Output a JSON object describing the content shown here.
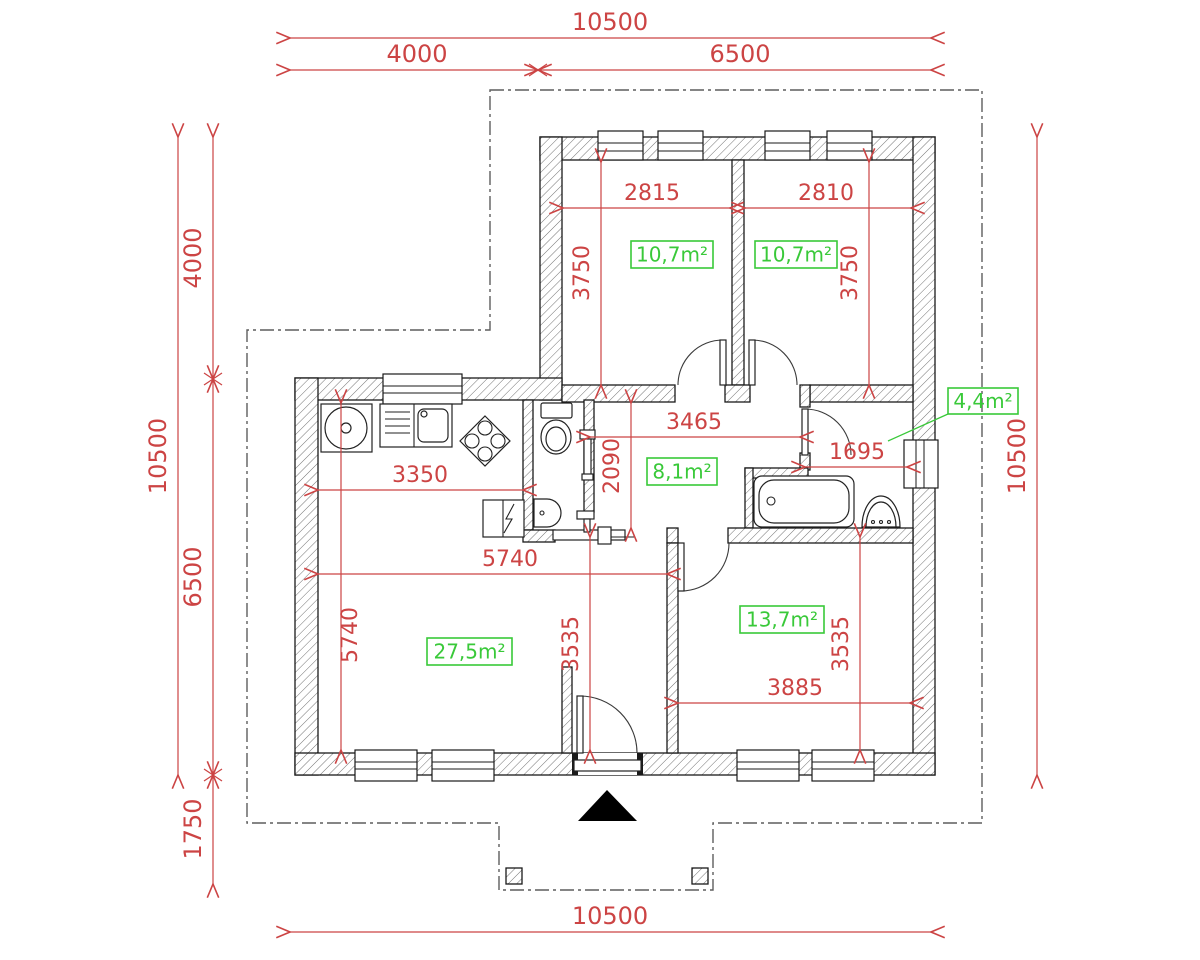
{
  "colors": {
    "dimension": "#cc4444",
    "area": "#39c939",
    "boundary": "#5d5d5d",
    "wall": "#1a1a1a"
  },
  "dimensions": [
    {
      "id": "top-overall",
      "label": "10500",
      "dir": "h",
      "a": 290,
      "b": 931,
      "pos": 38,
      "tx": 610,
      "ty": 30,
      "fs": 24
    },
    {
      "id": "top-left",
      "label": "4000",
      "dir": "h",
      "a": 290,
      "b": 538,
      "pos": 70,
      "tx": 417,
      "ty": 62,
      "fs": 24
    },
    {
      "id": "top-right",
      "label": "6500",
      "dir": "h",
      "a": 538,
      "b": 931,
      "pos": 70,
      "tx": 740,
      "ty": 62,
      "fs": 24
    },
    {
      "id": "bottom-overall",
      "label": "10500",
      "dir": "h",
      "a": 290,
      "b": 931,
      "pos": 932,
      "tx": 610,
      "ty": 924,
      "fs": 24
    },
    {
      "id": "left-overall",
      "label": "10500",
      "dir": "v",
      "a": 137,
      "b": 775,
      "pos": 178,
      "tx": 166,
      "ty": 456,
      "fs": 24
    },
    {
      "id": "left-4000",
      "label": "4000",
      "dir": "v",
      "a": 137,
      "b": 379,
      "pos": 213,
      "tx": 201,
      "ty": 258,
      "fs": 24
    },
    {
      "id": "left-6500",
      "label": "6500",
      "dir": "v",
      "a": 379,
      "b": 775,
      "pos": 213,
      "tx": 201,
      "ty": 577,
      "fs": 24
    },
    {
      "id": "left-1750",
      "label": "1750",
      "dir": "v",
      "a": 775,
      "b": 884,
      "pos": 213,
      "tx": 201,
      "ty": 829,
      "fs": 24
    },
    {
      "id": "right-overall",
      "label": "10500",
      "dir": "v",
      "a": 137,
      "b": 775,
      "pos": 1037,
      "tx": 1025,
      "ty": 456,
      "fs": 24
    },
    {
      "id": "bed1-width",
      "label": "2815",
      "dir": "h",
      "a": 563,
      "b": 730,
      "pos": 208,
      "tx": 652,
      "ty": 200,
      "fs": 22
    },
    {
      "id": "bed2-width",
      "label": "2810",
      "dir": "h",
      "a": 745,
      "b": 911,
      "pos": 208,
      "tx": 826,
      "ty": 200,
      "fs": 22
    },
    {
      "id": "bed1-height",
      "label": "3750",
      "dir": "v",
      "a": 162,
      "b": 385,
      "pos": 601,
      "tx": 589,
      "ty": 273,
      "fs": 22
    },
    {
      "id": "bed2-height",
      "label": "3750",
      "dir": "v",
      "a": 162,
      "b": 385,
      "pos": 869,
      "tx": 857,
      "ty": 273,
      "fs": 22
    },
    {
      "id": "hall-width",
      "label": "3465",
      "dir": "h",
      "a": 590,
      "b": 800,
      "pos": 437,
      "tx": 694,
      "ty": 429,
      "fs": 22
    },
    {
      "id": "hall-height",
      "label": "2090",
      "dir": "v",
      "a": 403,
      "b": 528,
      "pos": 631,
      "tx": 619,
      "ty": 466,
      "fs": 22
    },
    {
      "id": "bath-width",
      "label": "1695",
      "dir": "h",
      "a": 805,
      "b": 907,
      "pos": 467,
      "tx": 857,
      "ty": 459,
      "fs": 22
    },
    {
      "id": "kitchen-width",
      "label": "3350",
      "dir": "h",
      "a": 318,
      "b": 523,
      "pos": 490,
      "tx": 420,
      "ty": 482,
      "fs": 22
    },
    {
      "id": "living-width",
      "label": "5740",
      "dir": "h",
      "a": 318,
      "b": 667,
      "pos": 574,
      "tx": 510,
      "ty": 566,
      "fs": 22
    },
    {
      "id": "living-height",
      "label": "5740",
      "dir": "v",
      "a": 403,
      "b": 750,
      "pos": 341,
      "tx": 357,
      "ty": 635,
      "fs": 22
    },
    {
      "id": "living-height2",
      "label": "3535",
      "dir": "v",
      "a": 537,
      "b": 750,
      "pos": 590,
      "tx": 578,
      "ty": 644,
      "fs": 22
    },
    {
      "id": "bed3-height",
      "label": "3535",
      "dir": "v",
      "a": 537,
      "b": 750,
      "pos": 860,
      "tx": 848,
      "ty": 644,
      "fs": 22
    },
    {
      "id": "bed3-width",
      "label": "3885",
      "dir": "h",
      "a": 678,
      "b": 910,
      "pos": 703,
      "tx": 795,
      "ty": 695,
      "fs": 22
    }
  ],
  "junction_marks": [
    {
      "x": 538,
      "y": 70
    },
    {
      "x": 213,
      "y": 379
    },
    {
      "x": 213,
      "y": 775
    }
  ],
  "areas": [
    {
      "id": "bedroom-1",
      "label": "10,7m²",
      "x": 631,
      "y": 241,
      "w": 82,
      "h": 27
    },
    {
      "id": "bedroom-2",
      "label": "10,7m²",
      "x": 755,
      "y": 241,
      "w": 82,
      "h": 27
    },
    {
      "id": "hallway",
      "label": "8,1m²",
      "x": 647,
      "y": 458,
      "w": 70,
      "h": 27
    },
    {
      "id": "bathroom",
      "label": "4,4m²",
      "x": 948,
      "y": 388,
      "w": 70,
      "h": 26,
      "leader": [
        948,
        414,
        888,
        441
      ]
    },
    {
      "id": "living",
      "label": "27,5m²",
      "x": 427,
      "y": 638,
      "w": 85,
      "h": 27
    },
    {
      "id": "bedroom-3",
      "label": "13,7m²",
      "x": 740,
      "y": 606,
      "w": 84,
      "h": 27
    }
  ]
}
